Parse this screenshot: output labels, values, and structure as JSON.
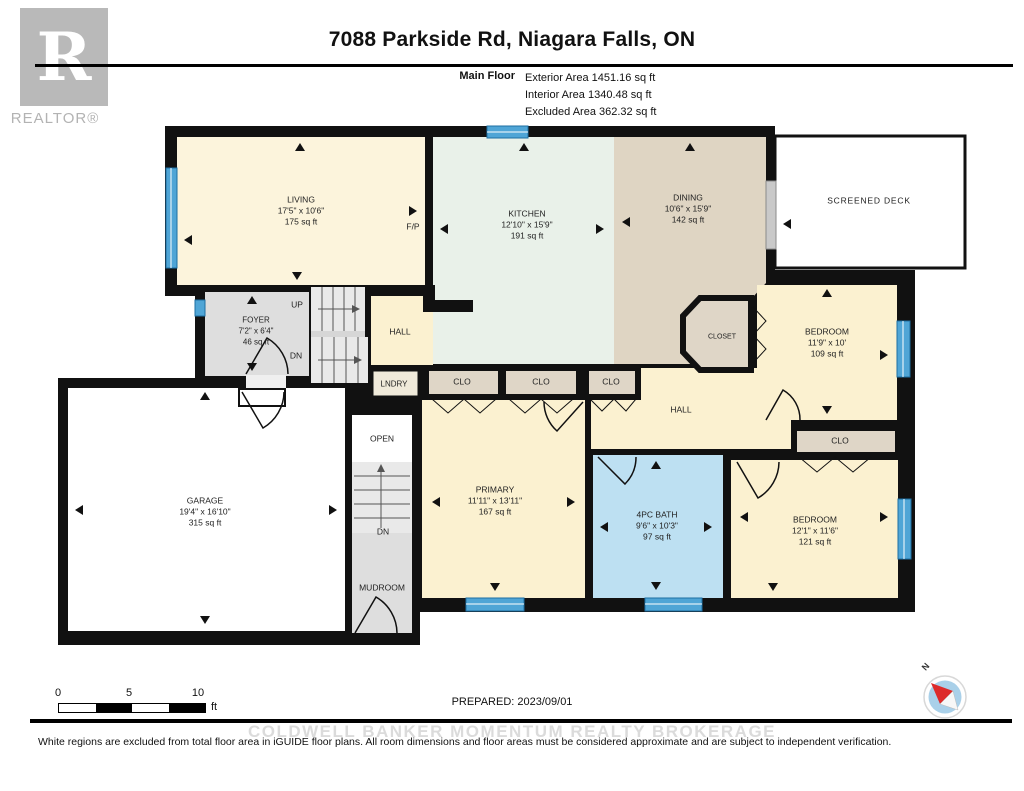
{
  "header": {
    "title": "7088 Parkside Rd, Niagara Falls, ON",
    "floor_label": "Main Floor",
    "area_lines": [
      "Exterior Area 1451.16 sq ft",
      "Interior Area 1340.48 sq ft",
      "Excluded Area 362.32 sq ft"
    ]
  },
  "logo": {
    "letter": "R",
    "text": "REALTOR®"
  },
  "rooms": {
    "living": {
      "name": "LIVING",
      "dims": "17'5\" x 10'6\"",
      "area": "175 sq ft"
    },
    "kitchen": {
      "name": "KITCHEN",
      "dims": "12'10\" x 15'9\"",
      "area": "191 sq ft"
    },
    "dining": {
      "name": "DINING",
      "dims": "10'6\" x 15'9\"",
      "area": "142 sq ft"
    },
    "deck": {
      "name": "SCREENED DECK"
    },
    "foyer": {
      "name": "FOYER",
      "dims": "7'2\" x 6'4\"",
      "area": "46 sq ft"
    },
    "bedroom1": {
      "name": "BEDROOM",
      "dims": "11'9\" x 10'",
      "area": "109 sq ft"
    },
    "primary": {
      "name": "PRIMARY",
      "dims": "11'11\" x 13'11\"",
      "area": "167 sq ft"
    },
    "bath": {
      "name": "4PC BATH",
      "dims": "9'6\" x 10'3\"",
      "area": "97 sq ft"
    },
    "bedroom2": {
      "name": "BEDROOM",
      "dims": "12'1\" x 11'6\"",
      "area": "121 sq ft"
    },
    "garage": {
      "name": "GARAGE",
      "dims": "19'4\" x 16'10\"",
      "area": "315 sq ft"
    }
  },
  "labels": {
    "up": "UP",
    "dn": "DN",
    "hall": "HALL",
    "lndry": "LNDRY",
    "clo": "CLO",
    "closet": "CLOSET",
    "open": "OPEN",
    "mudroom": "MUDROOM",
    "fp": "F/P",
    "north": "N"
  },
  "footer": {
    "scale": {
      "t0": "0",
      "t5": "5",
      "t10": "10",
      "unit": "ft"
    },
    "prepared": "PREPARED: 2023/09/01",
    "watermark": "COLDWELL BANKER MOMENTUM REALTY BROKERAGE",
    "disclaimer": "White regions are excluded from total floor area in iGUIDE floor plans. All room dimensions and floor areas must be considered approximate and are subject to independent verification."
  },
  "colors": {
    "wall": "#111111",
    "window": "#4FA5D6",
    "cream": "#FBF1D0",
    "kitchen": "#E9F1E9",
    "dining": "#DFD5C3",
    "closet": "#DFD6C7",
    "gray": "#DEDEDE",
    "bath": "#BDE0F2"
  }
}
